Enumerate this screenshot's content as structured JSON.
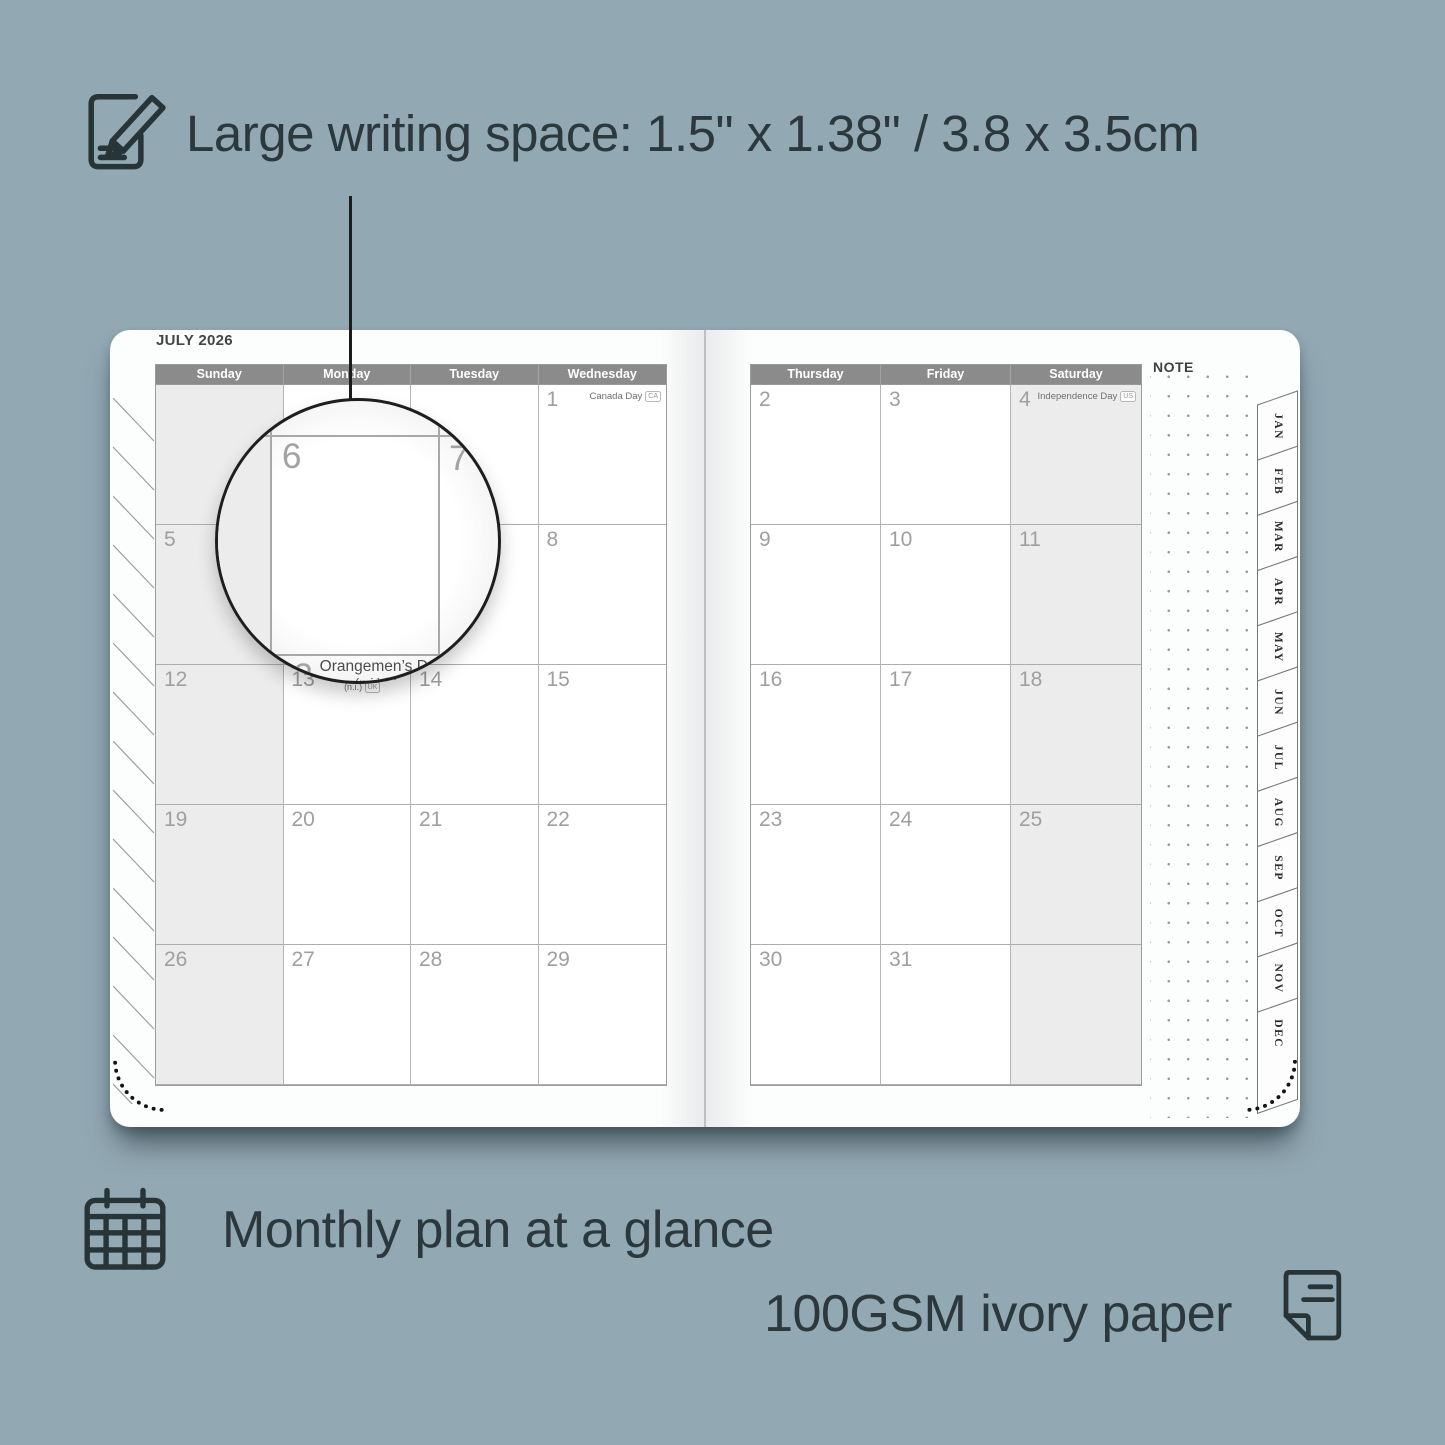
{
  "colors": {
    "background": "#92a8b3",
    "text_dark": "#2b383d",
    "page_white": "#fcfdfd",
    "header_bg": "#8b8b8b",
    "header_text": "#ffffff",
    "shaded_cell": "#ececec",
    "cell_border": "#b6b6b6",
    "day_number": "#9f9f9f"
  },
  "feature_top": {
    "icon": "pencil-note-icon",
    "label": "Large writing space: 1.5\" x 1.38\" / 3.8 x 3.5cm"
  },
  "features_bottom": [
    {
      "icon": "calendar-grid-icon",
      "label": "Monthly plan at a glance"
    },
    {
      "icon": "paper-icon",
      "label": "100GSM ivory paper"
    }
  ],
  "planner": {
    "month_title": "JULY 2026",
    "note_label": "NOTE",
    "left_page": {
      "day_headers": [
        "Sunday",
        "Monday",
        "Tuesday",
        "Wednesday"
      ],
      "weeks": [
        [
          {
            "day": ""
          },
          {
            "day": ""
          },
          {
            "day": ""
          },
          {
            "day": "1",
            "holiday": "Canada Day",
            "region": "CA"
          }
        ],
        [
          {
            "day": "5"
          },
          {
            "day": "6"
          },
          {
            "day": "7"
          },
          {
            "day": "8"
          }
        ],
        [
          {
            "day": "12"
          },
          {
            "day": "13",
            "holiday": "Orangemen’s Day",
            "holiday2": "(n.i.)",
            "region": "UK"
          },
          {
            "day": "14"
          },
          {
            "day": "15"
          }
        ],
        [
          {
            "day": "19"
          },
          {
            "day": "20"
          },
          {
            "day": "21"
          },
          {
            "day": "22"
          }
        ],
        [
          {
            "day": "26"
          },
          {
            "day": "27"
          },
          {
            "day": "28"
          },
          {
            "day": "29"
          }
        ]
      ]
    },
    "right_page": {
      "day_headers": [
        "Thursday",
        "Friday",
        "Saturday"
      ],
      "weeks": [
        [
          {
            "day": "2"
          },
          {
            "day": "3"
          },
          {
            "day": "4",
            "holiday": "Independence Day",
            "region": "US"
          }
        ],
        [
          {
            "day": "9"
          },
          {
            "day": "10"
          },
          {
            "day": "11"
          }
        ],
        [
          {
            "day": "16"
          },
          {
            "day": "17"
          },
          {
            "day": "18"
          }
        ],
        [
          {
            "day": "23"
          },
          {
            "day": "24"
          },
          {
            "day": "25"
          }
        ],
        [
          {
            "day": "30"
          },
          {
            "day": "31"
          },
          {
            "day": ""
          }
        ]
      ]
    },
    "month_tabs": [
      "JAN",
      "FEB",
      "MAR",
      "APR",
      "MAY",
      "JUN",
      "JUL",
      "AUG",
      "SEP",
      "OCT",
      "NOV",
      "DEC"
    ],
    "magnifier": {
      "day": "6",
      "next_day": "7",
      "below_day": "13",
      "holiday": "Orangemen’s Day",
      "holiday_line2": "(n.i.)",
      "region": "UK"
    }
  }
}
